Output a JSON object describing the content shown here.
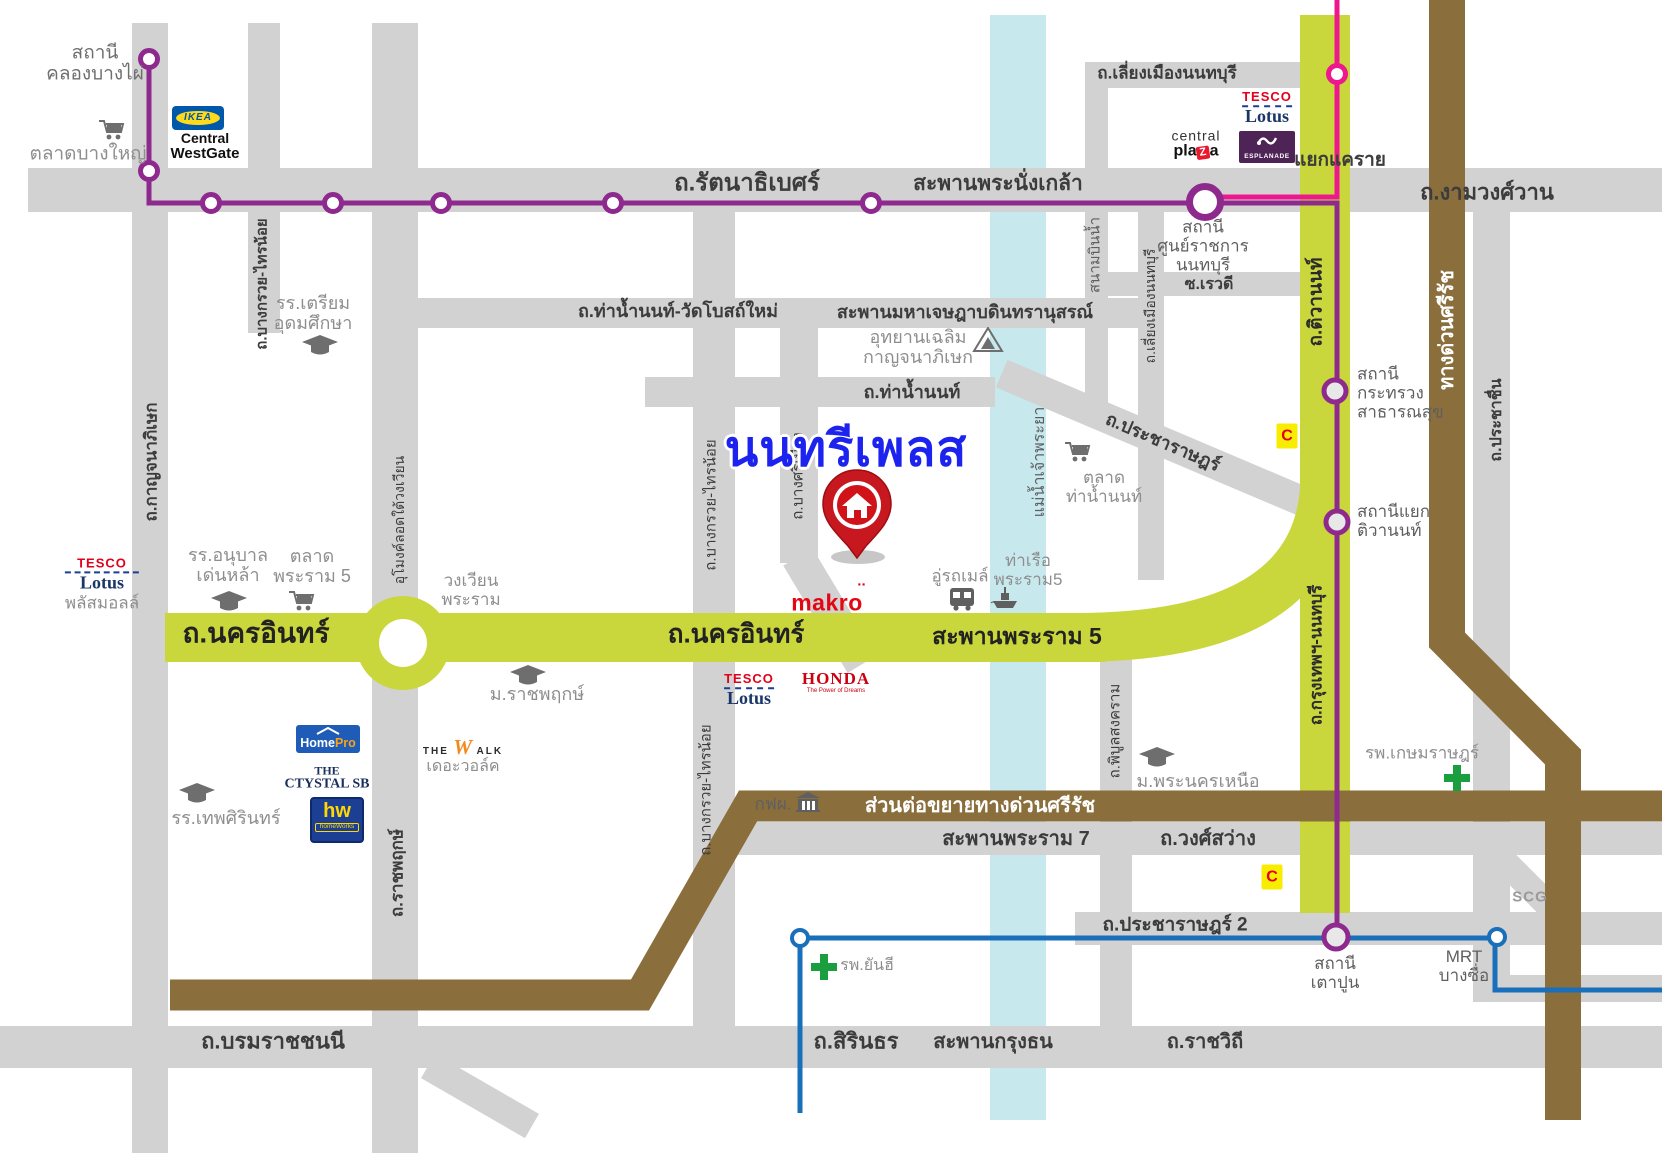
{
  "map": {
    "title": "นนทรีเพลส",
    "colors": {
      "road_gray": "#d2d2d3",
      "road_yellow": "#c9d63c",
      "expressway_brown": "#8a6e3c",
      "river_cyan": "#c7e9ed",
      "mrt_purple": "#8e2a8e",
      "mrt_pink": "#ee188e",
      "mrt_blue": "#1a6fba",
      "title_blue": "#1c23ef",
      "pin_red": "#c8181f"
    }
  },
  "logos": {
    "ikea": "IKEA",
    "central_westgate": {
      "l1": "Central",
      "l2": "WestGate"
    },
    "tesco": {
      "l1": "TESCO",
      "l2": "Lotus"
    },
    "tesco_left_sub": "พลัสมอลล์",
    "central_plaza": {
      "l1": "central",
      "p1": "pla",
      "z": "Z",
      "p2": "a"
    },
    "esplanade": "ESPLANADE",
    "honda": {
      "name": "HONDA",
      "tagline": "The Power of Dreams"
    },
    "makro": {
      "text": "makro",
      "accent": "¨"
    },
    "homepro": {
      "p1": "Home",
      "p2": "Pro"
    },
    "crystal": {
      "l1": "THE",
      "l2": "CTYSTAL SB"
    },
    "homeworks": {
      "hw": "hw",
      "sub": "homeWorks"
    },
    "thewalk": {
      "t1": "THE",
      "w": "W",
      "t2": "ALK",
      "sub": "เดอะวอล์ค"
    },
    "bigc": "C",
    "scg": "SCG"
  },
  "labels": [
    {
      "name": "st-khlong-bang-phai",
      "text": "สถานี\nคลองบางไผ่",
      "x": 95,
      "y": 64,
      "size": 19,
      "color": "#6f6f6f"
    },
    {
      "name": "lm-talat-bang-yai",
      "text": "ตลาดบางใหญ่",
      "x": 88,
      "y": 154,
      "size": 19,
      "color": "#8e8e8e"
    },
    {
      "name": "rd-kanchanaphisek",
      "text": "ถ.กาญจนาภิเษก",
      "x": 151,
      "y": 462,
      "size": 17,
      "color": "#3c3c3c",
      "w": 600,
      "rot": -90
    },
    {
      "name": "rd-bang-kruai-sai-noi-n",
      "text": "ถ.บางกรวย-ไทรน้อย",
      "x": 263,
      "y": 284,
      "size": 15,
      "color": "#3c3c3c",
      "w": 600,
      "rot": -90
    },
    {
      "name": "lm-triam-udom",
      "text": "รร.เตรียม\nอุดมศึกษา",
      "x": 313,
      "y": 313,
      "size": 18,
      "color": "#8e8e8e"
    },
    {
      "name": "rd-rattanathibet",
      "text": "ถ.รัตนาธิเบศร์",
      "x": 747,
      "y": 184,
      "size": 24,
      "color": "#3c3c3c",
      "w": 700
    },
    {
      "name": "rd-phra-nang-klao-bridge",
      "text": "สะพานพระนั่งเกล้า",
      "x": 998,
      "y": 184,
      "size": 21,
      "color": "#3c3c3c",
      "w": 700
    },
    {
      "name": "rd-liang-mueang-top",
      "text": "ถ.เลี่ยงเมืองนนทบุรี",
      "x": 1167,
      "y": 73,
      "size": 17,
      "color": "#3c3c3c",
      "w": 600
    },
    {
      "name": "rd-ngamwongwan",
      "text": "ถ.งามวงศ์วาน",
      "x": 1487,
      "y": 193,
      "size": 22,
      "color": "#3c3c3c",
      "w": 700
    },
    {
      "name": "rd-yaek-khae-rai",
      "text": "แยกแคราย",
      "x": 1340,
      "y": 160,
      "size": 19,
      "color": "#3c3c3c",
      "w": 600
    },
    {
      "name": "st-sun-ratchakan",
      "text": "สถานี\nศูนย์ราชการ\nนนทบุรี",
      "x": 1203,
      "y": 246,
      "size": 17,
      "color": "#5f5f5f"
    },
    {
      "name": "rd-soi-rewadee",
      "text": "ซ.เรวดี",
      "x": 1209,
      "y": 285,
      "size": 16,
      "color": "#3c3c3c",
      "w": 600
    },
    {
      "name": "rd-sanambinnam",
      "text": "สนามบินน้ำ",
      "x": 1096,
      "y": 255,
      "size": 15,
      "color": "#5f5f5f",
      "rot": -90
    },
    {
      "name": "rd-liang-mueang-s",
      "text": "ถ.เลี่ยงเมืองนนทบุรี",
      "x": 1151,
      "y": 306,
      "size": 14,
      "color": "#3c3c3c",
      "rot": -90
    },
    {
      "name": "rd-tha-nam-non-wat-bot-mai",
      "text": "ถ.ท่าน้ำนนท์-วัดโบสถ์ใหม่",
      "x": 678,
      "y": 311,
      "size": 18,
      "color": "#3c3c3c",
      "w": 600
    },
    {
      "name": "rd-maha-chetsada-bridge",
      "text": "สะพานมหาเจษฎาบดินทรานุสรณ์",
      "x": 965,
      "y": 312,
      "size": 18,
      "color": "#3c3c3c",
      "w": 600
    },
    {
      "name": "lm-uthayan-chalerm",
      "text": "อุทยานเฉลิม\nกาญจนาภิเษก",
      "x": 918,
      "y": 347,
      "size": 18,
      "color": "#8e8e8e"
    },
    {
      "name": "rd-tha-nam-non",
      "text": "ถ.ท่าน้ำนนท์",
      "x": 912,
      "y": 392,
      "size": 18,
      "color": "#3c3c3c",
      "w": 600
    },
    {
      "name": "rd-bang-kruai-sai-noi-m",
      "text": "ถ.บางกรวย-ไทรน้อย",
      "x": 712,
      "y": 505,
      "size": 15,
      "color": "#3c3c3c",
      "rot": -90
    },
    {
      "name": "rd-bang-si-mueang",
      "text": "ถ.บางศรีเมือง",
      "x": 799,
      "y": 476,
      "size": 15,
      "color": "#3c3c3c",
      "rot": -90
    },
    {
      "name": "river-chao-phraya",
      "text": "แม่น้ำเจ้าพระยา",
      "x": 1040,
      "y": 462,
      "size": 16,
      "color": "#5f5f5f",
      "rot": -90
    },
    {
      "name": "lm-talat-tha-nam-non",
      "text": "ตลาด\nท่าน้ำนนท์",
      "x": 1104,
      "y": 487,
      "size": 17,
      "color": "#8e8e8e"
    },
    {
      "name": "rd-pracharat",
      "text": "ถ.ประชาราษฎร์",
      "x": 1163,
      "y": 442,
      "size": 18,
      "color": "#3c3c3c",
      "w": 600,
      "rot": 23
    },
    {
      "name": "st-krasuang-satharanasuk",
      "text": "สถานี\nกระทรวง\nสาธารณสุข",
      "x": 1357,
      "y": 393,
      "size": 17,
      "color": "#5f5f5f",
      "align": "left"
    },
    {
      "name": "st-yaek-tiwanon",
      "text": "สถานีแยก\nติวานนท์",
      "x": 1357,
      "y": 521,
      "size": 17,
      "color": "#5f5f5f",
      "align": "left"
    },
    {
      "name": "rd-si-rat-expwy",
      "text": "ทางด่วนศรีรัช",
      "x": 1447,
      "y": 330,
      "size": 20,
      "color": "#ffffff",
      "w": 600,
      "rot": -90
    },
    {
      "name": "rd-prachachuen",
      "text": "ถ.ประชาชื่น",
      "x": 1497,
      "y": 420,
      "size": 16,
      "color": "#3c3c3c",
      "w": 600,
      "rot": -90
    },
    {
      "name": "rd-tiwanon",
      "text": "ถ.ติวานนท์",
      "x": 1316,
      "y": 302,
      "size": 19,
      "color": "#2b2b2b",
      "w": 700,
      "rot": -90
    },
    {
      "name": "lm-denla-school",
      "text": "รร.อนุบาล\nเด่นหล้า",
      "x": 228,
      "y": 565,
      "size": 18,
      "color": "#8e8e8e"
    },
    {
      "name": "lm-talat-rama5",
      "text": "ตลาด\nพระราม 5",
      "x": 312,
      "y": 566,
      "size": 18,
      "color": "#8e8e8e"
    },
    {
      "name": "rd-umong-rotary",
      "text": "อุโมงค์ลอดใต้วงเวียน",
      "x": 400,
      "y": 520,
      "size": 14,
      "color": "#3c3c3c",
      "rot": -90
    },
    {
      "name": "lm-wongwian-rama",
      "text": "วงเวียน\nพระราม",
      "x": 471,
      "y": 590,
      "size": 17,
      "color": "#8e8e8e"
    },
    {
      "name": "rd-nakhon-in-left",
      "text": "ถ.นครอินทร์",
      "x": 256,
      "y": 633,
      "size": 28,
      "color": "#222222",
      "w": 700
    },
    {
      "name": "rd-nakhon-in-mid",
      "text": "ถ.นครอินทร์",
      "x": 736,
      "y": 634,
      "size": 26,
      "color": "#222222",
      "w": 700
    },
    {
      "name": "rd-rama5-bridge",
      "text": "สะพานพระราม 5",
      "x": 1017,
      "y": 637,
      "size": 23,
      "color": "#222222",
      "w": 700
    },
    {
      "name": "lm-ratchaphruek-uni",
      "text": "ม.ราชพฤกษ์",
      "x": 537,
      "y": 694,
      "size": 18,
      "color": "#8e8e8e"
    },
    {
      "name": "lm-bus-depot",
      "text": "อู่รถเมล์",
      "x": 960,
      "y": 576,
      "size": 17,
      "color": "#8e8e8e"
    },
    {
      "name": "lm-rama5-pier",
      "text": "ท่าเรือ\nพระราม5",
      "x": 1028,
      "y": 570,
      "size": 17,
      "color": "#8e8e8e"
    },
    {
      "name": "lm-debsirin-school",
      "text": "รร.เทพศิรินทร์",
      "x": 226,
      "y": 818,
      "size": 18,
      "color": "#8e8e8e"
    },
    {
      "name": "rd-ratchaphruek",
      "text": "ถ.ราชพฤกษ์",
      "x": 397,
      "y": 873,
      "size": 17,
      "color": "#3c3c3c",
      "w": 600,
      "rot": -90
    },
    {
      "name": "rd-bang-kruai-sai-noi-s",
      "text": "ถ.บางกรวย-ไทรน้อย",
      "x": 707,
      "y": 790,
      "size": 15,
      "color": "#3c3c3c",
      "rot": -90
    },
    {
      "name": "lm-egat",
      "text": "กฟผ.",
      "x": 773,
      "y": 804,
      "size": 17,
      "color": "#5f5f5f"
    },
    {
      "name": "rd-si-rat-extension",
      "text": "ส่วนต่อขยายทางด่วนศรีรัช",
      "x": 980,
      "y": 806,
      "size": 20,
      "color": "#ffffff",
      "w": 600
    },
    {
      "name": "rd-rama7-bridge",
      "text": "สะพานพระราม 7",
      "x": 1016,
      "y": 839,
      "size": 20,
      "color": "#3c3c3c",
      "w": 600
    },
    {
      "name": "rd-wong-sawang",
      "text": "ถ.วงศ์สว่าง",
      "x": 1208,
      "y": 839,
      "size": 20,
      "color": "#3c3c3c",
      "w": 600
    },
    {
      "name": "rd-phibunsongkhram",
      "text": "ถ.พิบูลสงคราม",
      "x": 1116,
      "y": 731,
      "size": 15,
      "color": "#3c3c3c",
      "rot": -90
    },
    {
      "name": "lm-kmutnb",
      "text": "ม.พระนครเหนือ",
      "x": 1198,
      "y": 781,
      "size": 18,
      "color": "#8e8e8e"
    },
    {
      "name": "lm-kasemrad-hospital",
      "text": "รพ.เกษมราษฎร์",
      "x": 1422,
      "y": 753,
      "size": 17,
      "color": "#8e8e8e"
    },
    {
      "name": "rd-pracharat2",
      "text": "ถ.ประชาราษฎร์ 2",
      "x": 1175,
      "y": 925,
      "size": 19,
      "color": "#3c3c3c",
      "w": 600
    },
    {
      "name": "st-taopoon",
      "text": "สถานี\nเตาปูน",
      "x": 1335,
      "y": 973,
      "size": 17,
      "color": "#5f5f5f"
    },
    {
      "name": "st-mrt-bangsue",
      "text": "MRT\nบางซื่อ",
      "x": 1464,
      "y": 966,
      "size": 17,
      "color": "#5f5f5f"
    },
    {
      "name": "lm-yanhee-hospital",
      "text": "รพ.ยันฮี",
      "x": 867,
      "y": 966,
      "size": 16,
      "color": "#8e8e8e"
    },
    {
      "name": "rd-borommaratchachonnani",
      "text": "ถ.บรมราชชนนี",
      "x": 273,
      "y": 1042,
      "size": 22,
      "color": "#3c3c3c",
      "w": 700
    },
    {
      "name": "rd-sirindhorn",
      "text": "ถ.สิรินธร",
      "x": 856,
      "y": 1042,
      "size": 22,
      "color": "#3c3c3c",
      "w": 700
    },
    {
      "name": "rd-krungthon-bridge",
      "text": "สะพานกรุงธน",
      "x": 993,
      "y": 1042,
      "size": 20,
      "color": "#3c3c3c",
      "w": 600
    },
    {
      "name": "rd-ratchawithi",
      "text": "ถ.ราชวิถี",
      "x": 1205,
      "y": 1042,
      "size": 20,
      "color": "#3c3c3c",
      "w": 600
    },
    {
      "name": "rd-krungthep-nonthaburi",
      "text": "ถ.กรุงเทพฯ-นนทบุรี",
      "x": 1316,
      "y": 655,
      "size": 17,
      "color": "#2b2b2b",
      "w": 700,
      "rot": -90
    },
    {
      "name": "map-title",
      "text": "นนทรีเพลส",
      "x": 846,
      "y": 450,
      "size": 49,
      "color": "#1c23ef",
      "w": 800,
      "halo": true
    }
  ],
  "circles": [
    {
      "name": "mrt-station-khlong-bang-phai",
      "x": 149,
      "y": 59,
      "d": 22,
      "ring": 5,
      "color": "#8e2a8e",
      "fill": "#ffffff"
    },
    {
      "name": "mrt-station-purple",
      "x": 149,
      "y": 171,
      "d": 22,
      "ring": 5,
      "color": "#8e2a8e",
      "fill": "#ffffff"
    },
    {
      "name": "mrt-station-purple",
      "x": 211,
      "y": 203,
      "d": 22,
      "ring": 5,
      "color": "#8e2a8e",
      "fill": "#ffffff"
    },
    {
      "name": "mrt-station-purple",
      "x": 333,
      "y": 203,
      "d": 22,
      "ring": 5,
      "color": "#8e2a8e",
      "fill": "#ffffff"
    },
    {
      "name": "mrt-station-purple",
      "x": 441,
      "y": 203,
      "d": 22,
      "ring": 5,
      "color": "#8e2a8e",
      "fill": "#ffffff"
    },
    {
      "name": "mrt-station-purple",
      "x": 613,
      "y": 203,
      "d": 22,
      "ring": 5,
      "color": "#8e2a8e",
      "fill": "#ffffff"
    },
    {
      "name": "mrt-station-purple",
      "x": 871,
      "y": 203,
      "d": 22,
      "ring": 5,
      "color": "#8e2a8e",
      "fill": "#ffffff"
    },
    {
      "name": "mrt-interchange-khae-rai",
      "x": 1205,
      "y": 202,
      "d": 38,
      "ring": 7,
      "color": "#8e2a8e",
      "fill": "#ffffff"
    },
    {
      "name": "mrt-station-krasuang",
      "x": 1335,
      "y": 391,
      "d": 27,
      "ring": 5,
      "color": "#8e2a8e",
      "fill": "#e8e8e8"
    },
    {
      "name": "mrt-station-yaek-tiwanon",
      "x": 1337,
      "y": 522,
      "d": 27,
      "ring": 5,
      "color": "#8e2a8e",
      "fill": "#e8e8e8"
    },
    {
      "name": "mrt-station-taopoon",
      "x": 1336,
      "y": 937,
      "d": 29,
      "ring": 5,
      "color": "#8e2a8e",
      "fill": "#e8e8e8"
    },
    {
      "name": "mrt-station-pink",
      "x": 1337,
      "y": 74,
      "d": 22,
      "ring": 5,
      "color": "#ee188e",
      "fill": "#ffffff"
    },
    {
      "name": "mrt-station-blue-west",
      "x": 800,
      "y": 938,
      "d": 20,
      "ring": 4,
      "color": "#1a6fba",
      "fill": "#ffffff"
    },
    {
      "name": "mrt-station-bangsue",
      "x": 1497,
      "y": 937,
      "d": 20,
      "ring": 4,
      "color": "#1a6fba",
      "fill": "#ffffff"
    }
  ]
}
